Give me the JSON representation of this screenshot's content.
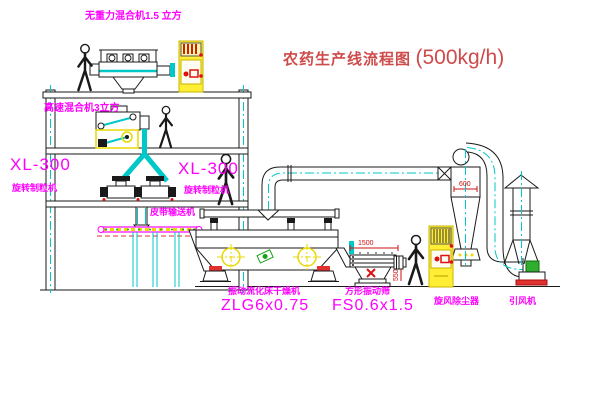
{
  "title": {
    "text": "农药生产线流程图",
    "capacity": "(500kg/h)"
  },
  "labels": {
    "no_gravity_mixer": "无重力混合机1.5 立方",
    "high_speed_mixer": "高速混合机3立方",
    "granulator_left_model": "XL-300",
    "granulator_left_name": "旋转制粒机",
    "granulator_right_model": "XL-300",
    "granulator_right_name": "旋转制粒机",
    "belt_conveyor": "皮带输送机",
    "dryer_name": "振动流化床干燥机",
    "dryer_model": "ZLG6x0.75",
    "sieve_name": "方形振动筛",
    "sieve_model": "FS0.6x1.5",
    "cyclone_name": "旋风除尘器",
    "fan_name": "引风机"
  },
  "dimensions": {
    "sieve_length": "1500",
    "sieve_height": "550",
    "cyclone_diameter": "600"
  },
  "colors": {
    "line_black": "#1a1a1a",
    "line_cyan": "#00c8c8",
    "label_magenta": "#ff00ff",
    "title_red": "#cf4a4a",
    "dimension_red": "#cc1111",
    "highlight_yellow": "#f2e300"
  }
}
